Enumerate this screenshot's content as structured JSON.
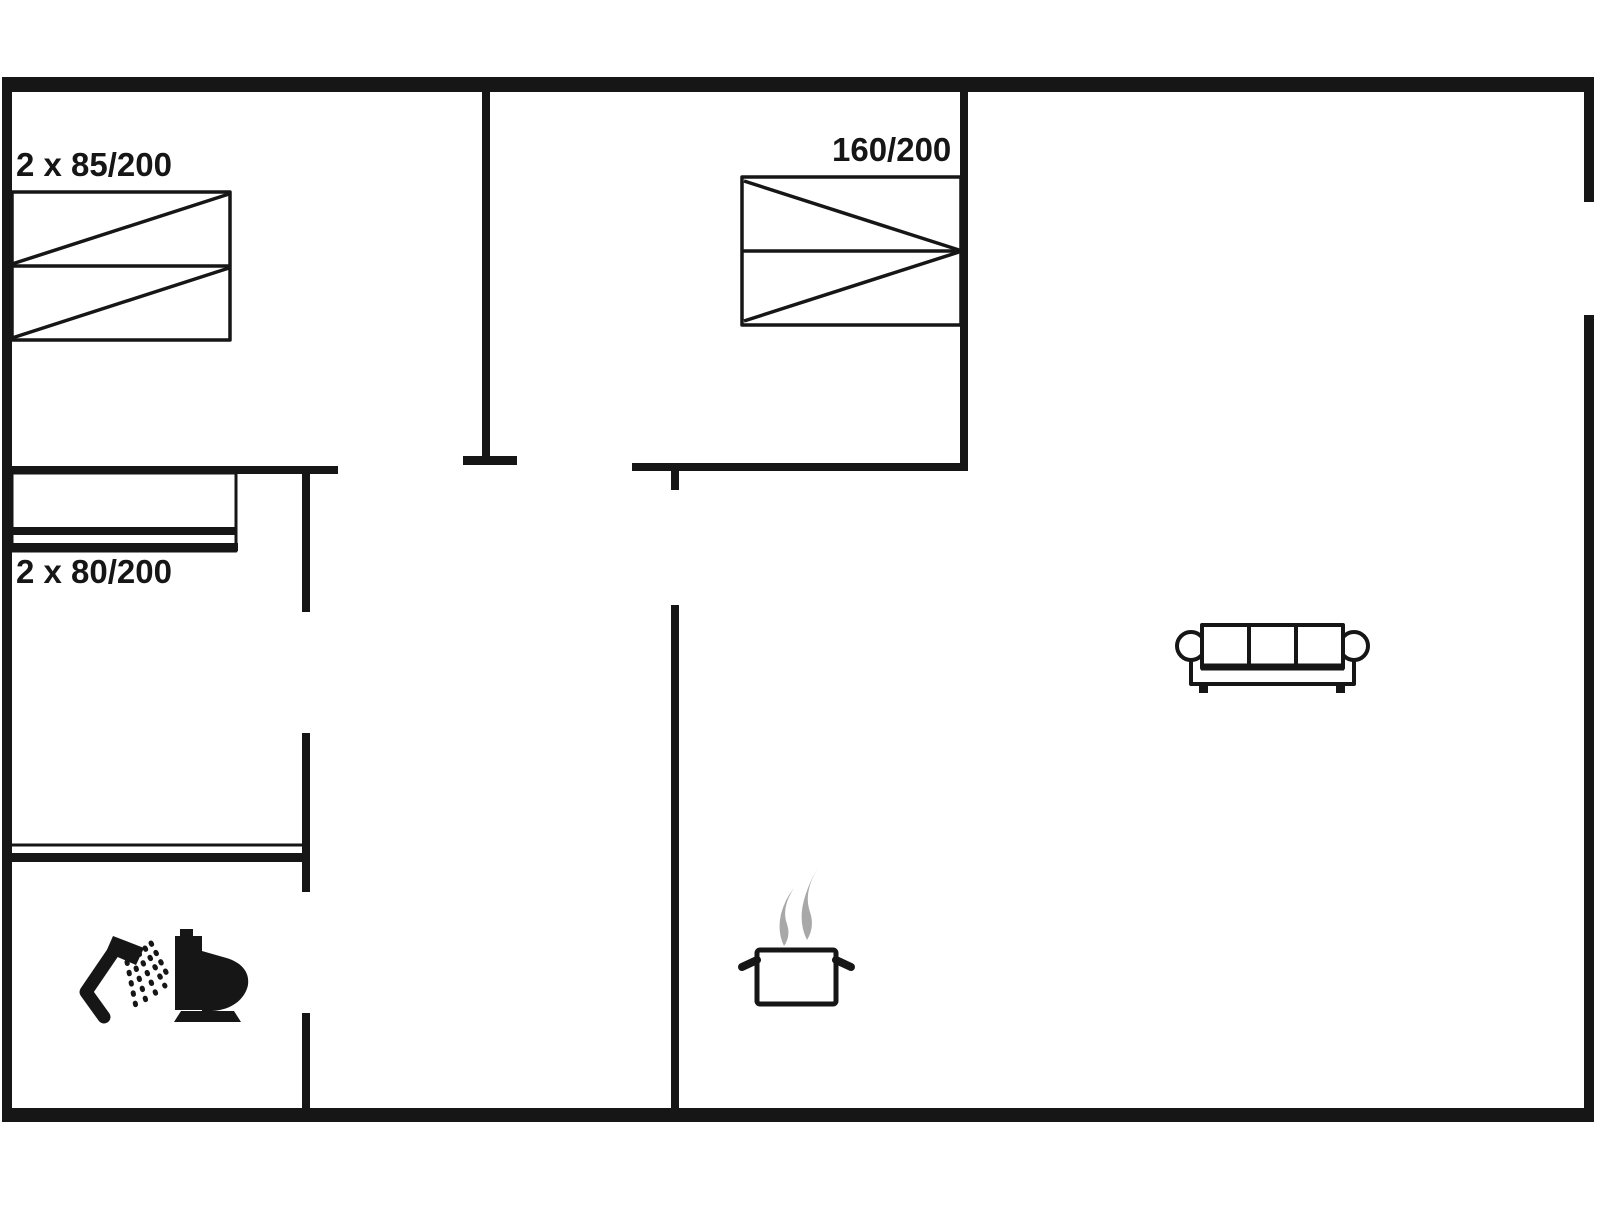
{
  "colors": {
    "line": "#161616",
    "steam": "#a8a8a8",
    "bg": "#ffffff"
  },
  "labels": [
    {
      "name": "bed-size-label-left",
      "text": "2 x 85/200",
      "left": 16,
      "top": 148
    },
    {
      "name": "bed-size-label-middle",
      "text": "160/200",
      "left": 832,
      "top": 133
    },
    {
      "name": "bunk-size-label",
      "text": "2 x 80/200",
      "left": 16,
      "top": 555
    }
  ],
  "shapes": [
    {
      "type": "rect",
      "name": "wall-outer-top",
      "x": 2,
      "y": 77,
      "w": 1592,
      "h": 15,
      "fill": "line"
    },
    {
      "type": "rect",
      "name": "wall-outer-bottom",
      "x": 2,
      "y": 1108,
      "w": 1592,
      "h": 14,
      "fill": "line"
    },
    {
      "type": "rect",
      "name": "wall-outer-left",
      "x": 2,
      "y": 77,
      "w": 10,
      "h": 1045,
      "fill": "line"
    },
    {
      "type": "rect",
      "name": "wall-outer-right-upper",
      "x": 1584,
      "y": 77,
      "w": 10,
      "h": 125,
      "fill": "line"
    },
    {
      "type": "rect",
      "name": "wall-outer-right-lower",
      "x": 1584,
      "y": 315,
      "w": 10,
      "h": 807,
      "fill": "line"
    },
    {
      "type": "rect",
      "name": "wall-bedroom1-right",
      "x": 482,
      "y": 92,
      "w": 8,
      "h": 366,
      "fill": "line"
    },
    {
      "type": "rect",
      "name": "wall-bedroom1-right-endcap",
      "x": 463,
      "y": 456,
      "w": 54,
      "h": 9,
      "fill": "line"
    },
    {
      "type": "rect",
      "name": "wall-bedroom2-right",
      "x": 960,
      "y": 92,
      "w": 8,
      "h": 379,
      "fill": "line"
    },
    {
      "type": "rect",
      "name": "wall-bedroom2-bottom",
      "x": 632,
      "y": 463,
      "w": 336,
      "h": 8,
      "fill": "line"
    },
    {
      "type": "rect",
      "name": "wall-bedroom1-bottom",
      "x": 12,
      "y": 466,
      "w": 326,
      "h": 8,
      "fill": "line"
    },
    {
      "type": "rect",
      "name": "wall-hall-left-upper",
      "x": 302,
      "y": 470,
      "w": 8,
      "h": 142,
      "fill": "line"
    },
    {
      "type": "rect",
      "name": "wall-kitchen-stub",
      "x": 671,
      "y": 471,
      "w": 8,
      "h": 19,
      "fill": "line"
    },
    {
      "type": "rect",
      "name": "wall-kitchen-divider",
      "x": 671,
      "y": 605,
      "w": 8,
      "h": 503,
      "fill": "line"
    },
    {
      "type": "rect",
      "name": "wall-hall-left-middle",
      "x": 302,
      "y": 733,
      "w": 8,
      "h": 159,
      "fill": "line"
    },
    {
      "type": "rect",
      "name": "wall-bathroom-top",
      "x": 2,
      "y": 853,
      "w": 308,
      "h": 9,
      "fill": "line"
    },
    {
      "type": "rect",
      "name": "wall-bathroom-right-lower",
      "x": 302,
      "y": 1013,
      "w": 8,
      "h": 95,
      "fill": "line"
    },
    {
      "type": "line",
      "name": "bathroom-top-inner-line",
      "x1": 12,
      "y1": 845,
      "x2": 302,
      "y2": 845,
      "stroke": "line",
      "sw": 3
    },
    {
      "type": "rect",
      "name": "bed-left-outline",
      "x": 12,
      "y": 192,
      "w": 218,
      "h": 148,
      "stroke": "line",
      "sw": 3.5,
      "fill": "none"
    },
    {
      "type": "line",
      "name": "bed-left-divider",
      "x1": 12,
      "y1": 266,
      "x2": 230,
      "y2": 266,
      "stroke": "line",
      "sw": 3.5
    },
    {
      "type": "line",
      "name": "bed-left-diagonal-top",
      "x1": 12,
      "y1": 264,
      "x2": 229,
      "y2": 194,
      "stroke": "line",
      "sw": 3.5
    },
    {
      "type": "line",
      "name": "bed-left-diagonal-bottom",
      "x1": 12,
      "y1": 338,
      "x2": 229,
      "y2": 268,
      "stroke": "line",
      "sw": 3.5
    },
    {
      "type": "rect",
      "name": "bed-middle-outline",
      "x": 742,
      "y": 177,
      "w": 219,
      "h": 148,
      "stroke": "line",
      "sw": 3.5,
      "fill": "none"
    },
    {
      "type": "line",
      "name": "bed-middle-divider",
      "x1": 742,
      "y1": 251,
      "x2": 961,
      "y2": 251,
      "stroke": "line",
      "sw": 3.5
    },
    {
      "type": "line",
      "name": "bed-middle-diagonal-top",
      "x1": 744,
      "y1": 181,
      "x2": 959,
      "y2": 250,
      "stroke": "line",
      "sw": 3.5
    },
    {
      "type": "line",
      "name": "bed-middle-diagonal-bottom",
      "x1": 744,
      "y1": 321,
      "x2": 959,
      "y2": 252,
      "stroke": "line",
      "sw": 3.5
    },
    {
      "type": "rect",
      "name": "bunk-bed-outline",
      "x": 12,
      "y": 473,
      "w": 224,
      "h": 78,
      "stroke": "line",
      "sw": 3,
      "fill": "none"
    },
    {
      "type": "line",
      "name": "bunk-bed-thick-line-upper",
      "x1": 12,
      "y1": 531,
      "x2": 236,
      "y2": 531,
      "stroke": "line",
      "sw": 8
    },
    {
      "type": "line",
      "name": "bunk-bed-thick-line-lower",
      "x1": 10,
      "y1": 547,
      "x2": 238,
      "y2": 547,
      "stroke": "line",
      "sw": 8
    },
    {
      "type": "path",
      "name": "sofa-body",
      "d": "M1191,650 L1191,684 L1354,684 L1354,650",
      "stroke": "line",
      "sw": 4,
      "fill": "none"
    },
    {
      "type": "rect",
      "name": "sofa-foot-left",
      "x": 1199,
      "y": 684,
      "w": 9,
      "h": 9,
      "fill": "line"
    },
    {
      "type": "rect",
      "name": "sofa-foot-right",
      "x": 1336,
      "y": 684,
      "w": 9,
      "h": 9,
      "fill": "line"
    },
    {
      "type": "circle",
      "name": "sofa-armrest-left",
      "cx": 1191,
      "cy": 646,
      "r": 14,
      "stroke": "line",
      "sw": 4,
      "fill": "bg"
    },
    {
      "type": "circle",
      "name": "sofa-armrest-right",
      "cx": 1354,
      "cy": 646,
      "r": 14,
      "stroke": "line",
      "sw": 4,
      "fill": "bg"
    },
    {
      "type": "rect",
      "name": "sofa-backrest",
      "x": 1202,
      "y": 625,
      "w": 141,
      "h": 43,
      "stroke": "line",
      "sw": 4,
      "fill": "bg"
    },
    {
      "type": "line",
      "name": "sofa-cushion-divider-1",
      "x1": 1249,
      "y1": 625,
      "x2": 1249,
      "y2": 668,
      "stroke": "line",
      "sw": 4
    },
    {
      "type": "line",
      "name": "sofa-cushion-divider-2",
      "x1": 1296,
      "y1": 625,
      "x2": 1296,
      "y2": 668,
      "stroke": "line",
      "sw": 4
    },
    {
      "type": "line",
      "name": "sofa-seat-front",
      "x1": 1201,
      "y1": 667,
      "x2": 1344,
      "y2": 667,
      "stroke": "line",
      "sw": 7
    },
    {
      "type": "path",
      "name": "steam-wisp-left",
      "d": "M794,888 Q781,908 787,924 Q791,936 784,946 Q777,932 781,914 Q785,899 794,888 Z",
      "fill": "steam"
    },
    {
      "type": "path",
      "name": "steam-wisp-right",
      "d": "M818,868 Q803,892 810,912 Q815,927 807,940 Q798,922 804,900 Q809,882 818,868 Z",
      "fill": "steam"
    },
    {
      "type": "rect",
      "name": "pot-body",
      "x": 757,
      "y": 950,
      "w": 79,
      "h": 54,
      "rx": 3,
      "stroke": "line",
      "sw": 5,
      "fill": "none"
    },
    {
      "type": "line",
      "name": "pot-handle-left",
      "x1": 757,
      "y1": 960,
      "x2": 742,
      "y2": 967,
      "stroke": "line",
      "sw": 8,
      "cap": "round"
    },
    {
      "type": "line",
      "name": "pot-handle-right",
      "x1": 836,
      "y1": 960,
      "x2": 851,
      "y2": 967,
      "stroke": "line",
      "sw": 8,
      "cap": "round"
    },
    {
      "type": "path",
      "name": "shower-arm",
      "d": "M104,1017 L86,992 L116,948",
      "stroke": "line",
      "sw": 13,
      "fill": "none",
      "cap": "round"
    },
    {
      "type": "path",
      "name": "shower-head",
      "d": "M113,936 L144,948 L136,965 L106,952 Z",
      "fill": "line"
    },
    {
      "type": "line",
      "name": "shower-spray-row-1",
      "x1": 127,
      "y1": 962,
      "x2": 136,
      "y2": 1007,
      "stroke": "line",
      "sw": 5,
      "cap": "round",
      "dash": "1.5,9"
    },
    {
      "type": "line",
      "name": "shower-spray-row-2",
      "x1": 133,
      "y1": 958,
      "x2": 146,
      "y2": 1001,
      "stroke": "line",
      "sw": 5,
      "cap": "round",
      "dash": "1.5,9"
    },
    {
      "type": "line",
      "name": "shower-spray-row-3",
      "x1": 139,
      "y1": 953,
      "x2": 156,
      "y2": 994,
      "stroke": "line",
      "sw": 5,
      "cap": "round",
      "dash": "1.5,9"
    },
    {
      "type": "line",
      "name": "shower-spray-row-4",
      "x1": 145,
      "y1": 948,
      "x2": 165,
      "y2": 986,
      "stroke": "line",
      "sw": 5,
      "cap": "round",
      "dash": "1.5,9"
    },
    {
      "type": "line",
      "name": "shower-spray-row-5",
      "x1": 151,
      "y1": 943,
      "x2": 168,
      "y2": 976,
      "stroke": "line",
      "sw": 5,
      "cap": "round",
      "dash": "1.5,9"
    },
    {
      "type": "rect",
      "name": "toilet-tank",
      "x": 175,
      "y": 936,
      "w": 27,
      "h": 74,
      "fill": "line"
    },
    {
      "type": "rect",
      "name": "toilet-button",
      "x": 180,
      "y": 929,
      "w": 13,
      "h": 8,
      "fill": "line"
    },
    {
      "type": "path",
      "name": "toilet-bowl",
      "d": "M202,950 L202,1011 L212,1011 C232,1010 245,999 248,985 C250,971 240,961 223,957 L202,951 Z",
      "fill": "line"
    },
    {
      "type": "path",
      "name": "toilet-base",
      "d": "M181,1011 L234,1011 L241,1022 L174,1022 Z",
      "fill": "line"
    }
  ]
}
